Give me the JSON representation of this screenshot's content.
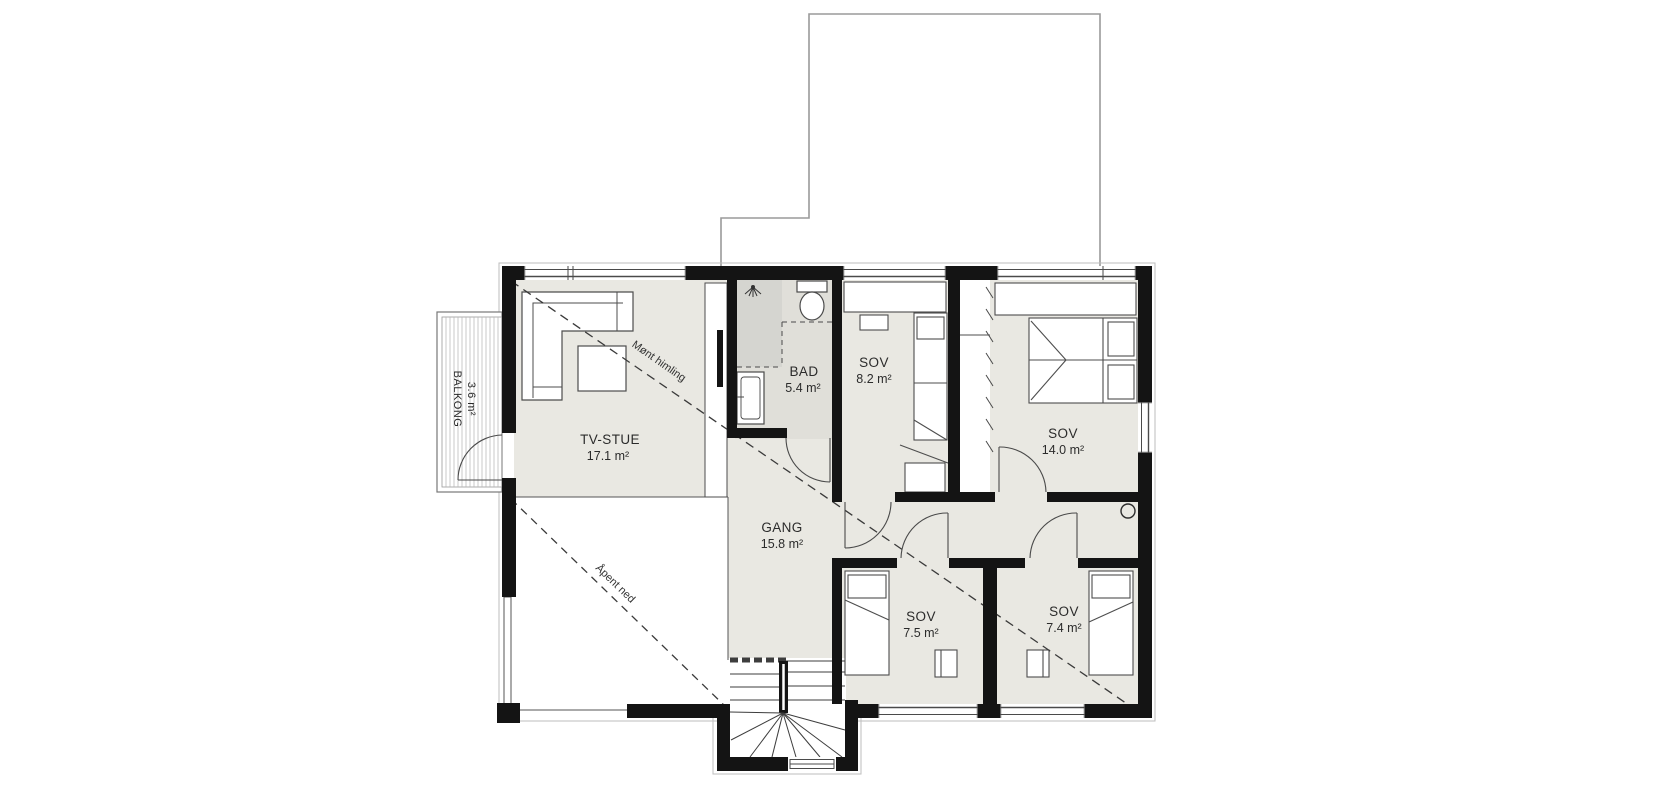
{
  "plan": {
    "type": "floor-plan",
    "floor": "loft / bedroom level",
    "rooms": [
      {
        "id": "tv-stue",
        "label": "TV-STUE",
        "area": "17.1 m²"
      },
      {
        "id": "bad",
        "label": "BAD",
        "area": "5.4 m²"
      },
      {
        "id": "sov-8-2",
        "label": "SOV",
        "area": "8.2 m²"
      },
      {
        "id": "sov-14-0",
        "label": "SOV",
        "area": "14.0 m²"
      },
      {
        "id": "gang",
        "label": "GANG",
        "area": "15.8 m²"
      },
      {
        "id": "sov-7-5",
        "label": "SOV",
        "area": "7.5 m²"
      },
      {
        "id": "sov-7-4",
        "label": "SOV",
        "area": "7.4 m²"
      },
      {
        "id": "balkong",
        "label": "BALKONG",
        "area": "3.6 m²"
      }
    ],
    "annotations": [
      {
        "id": "ridge-ceiling",
        "text": "Mønt himling"
      },
      {
        "id": "open-below",
        "text": "Åpent ned"
      }
    ],
    "colors": {
      "wall": "#141414",
      "floor": "#e9e8e2",
      "bath_floor": "#e0dfd9",
      "shower_zone": "#d5d5d0",
      "outline": "#9a9a9a",
      "line": "#4a4a4a"
    }
  }
}
